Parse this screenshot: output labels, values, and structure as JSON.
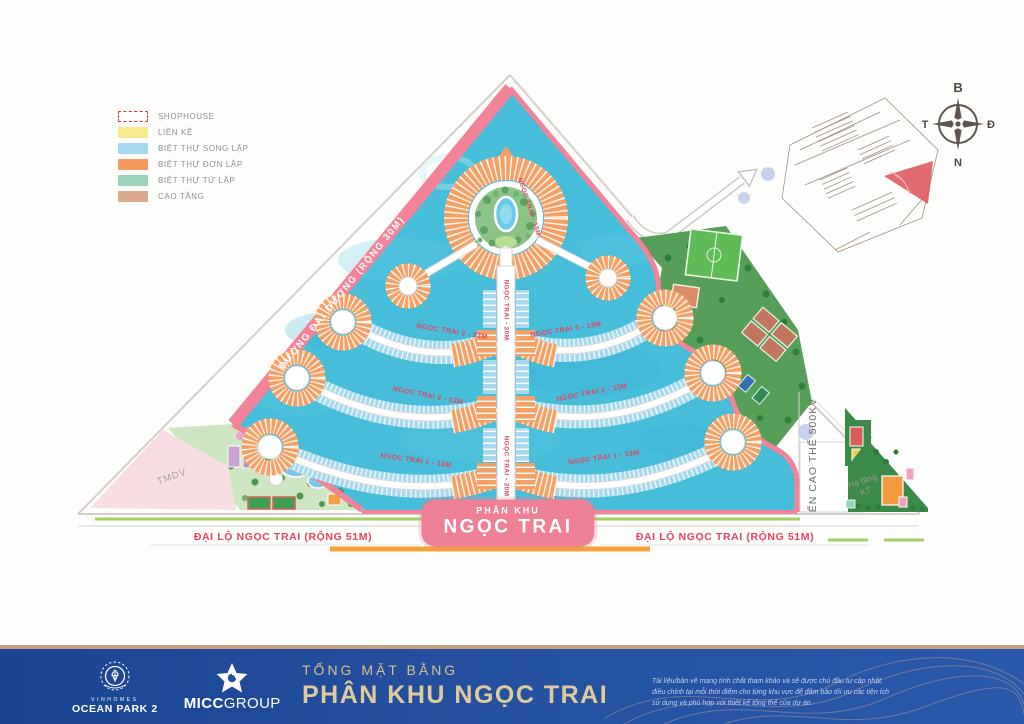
{
  "legend": {
    "items": [
      {
        "label": "SHOPHOUSE",
        "color": "#ffffff",
        "swatch": "dashed-red"
      },
      {
        "label": "LIỀN KỀ",
        "color": "#f7e98e"
      },
      {
        "label": "BIỆT THỰ SONG LẬP",
        "color": "#a4d8f0"
      },
      {
        "label": "BIỆT THỰ ĐƠN LẬP",
        "color": "#f5995f"
      },
      {
        "label": "BIỆT THỰ TỨ LẬP",
        "color": "#9bd2ba"
      },
      {
        "label": "CAO TẦNG",
        "color": "#d9aa89"
      }
    ]
  },
  "map": {
    "badge": {
      "line1": "PHÂN KHU",
      "line2": "NGỌC TRAI",
      "color": "#ee8095"
    },
    "roads": {
      "ocean_road": "ĐƯỜNG ĐẠI DƯƠNG (RỘNG 30M)",
      "boulevard": "ĐẠI LỘ NGỌC TRAI (RỘNG 51M)",
      "power_line": "ẾN CAO THẾ 500KV"
    },
    "streets": {
      "ring": "NGỌC TRAI - 15M",
      "spine": "NGỌC TRAI - 20M",
      "arc3": "NGỌC TRAI 3 - 13M",
      "arc2": "NGỌC TRAI 2 - 13M",
      "arc1": "NGỌC TRAI 1 - 13M"
    },
    "areas": {
      "commercial": "TMDV",
      "infrastructure_line1": "Hạ tầng",
      "infrastructure_line2": "KT"
    },
    "compass": {
      "north": "B",
      "south": "N",
      "east": "Đ",
      "west": "T"
    },
    "water_color": "#46bdd9",
    "boundary_color": "#f28398"
  },
  "footer": {
    "brand1_line1": "VINHOMES",
    "brand1_line2": "OCEAN PARK 2",
    "brand2_bold": "MICC",
    "brand2_light": "GROUP",
    "title_small": "TỔNG MẶT BẰNG",
    "title_large": "PHÂN KHU NGỌC TRAI",
    "disclaimer": "Tài liệu/bản vẽ mang tính chất tham khảo và sẽ được chủ đầu tư cập nhật, điều chỉnh tại mỗi thời điểm cho từng khu vực để đảm bảo tối ưu các tiện ích sử dụng và phù hợp với thiết kế tổng thể của dự án."
  }
}
